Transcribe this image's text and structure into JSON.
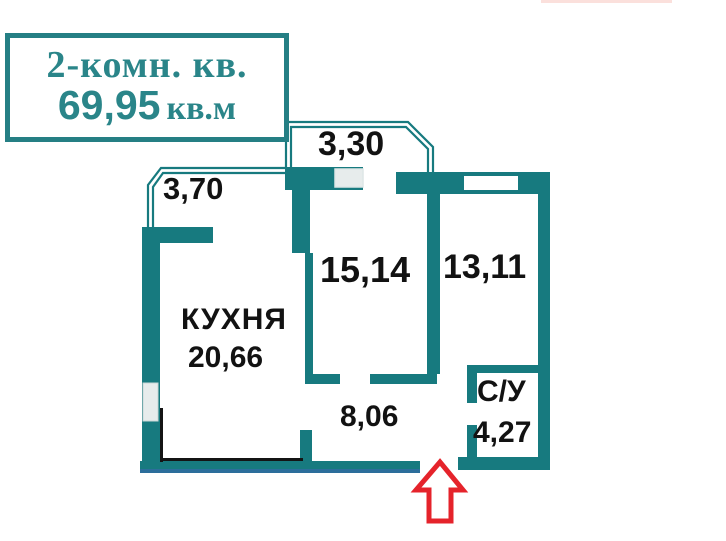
{
  "title_box": {
    "type_label": "2-комн. кв.",
    "area_value": "69,95",
    "area_unit": "кв.м"
  },
  "labels": {
    "balcony_top": "3,30",
    "balcony_left": "3,70",
    "room_middle": "15,14",
    "room_right": "13,11",
    "kitchen_name": "КУХНЯ",
    "kitchen_area": "20,66",
    "hallway": "8,06",
    "bathroom_name": "С/У",
    "bathroom_area": "4,27"
  },
  "colors": {
    "wall_teal": "#177a7f",
    "accent_text_teal": "#2a8589",
    "room_text": "#121212",
    "entrance_arrow_red": "#e5232b",
    "baseline_blue": "#2c6e9b",
    "window_gray": "#e7ecec",
    "faint_top_line_pink": "#fbe0dc"
  },
  "icons": {
    "entrance_arrow": "block-arrow-up-icon"
  }
}
